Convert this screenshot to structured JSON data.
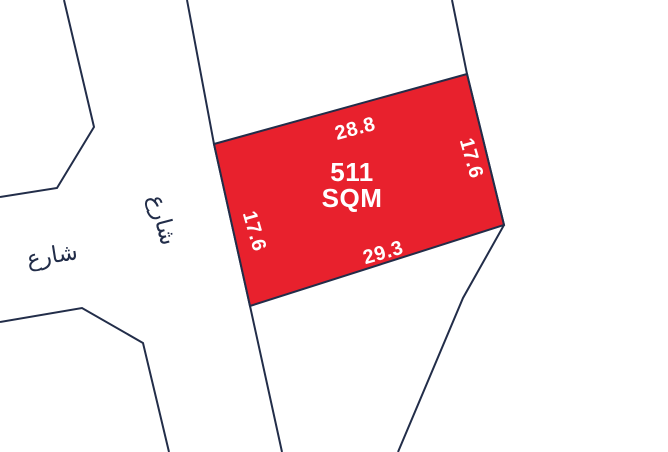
{
  "map": {
    "parcel": {
      "area_value": "511",
      "area_unit": "SQM",
      "dimensions": {
        "top": "28.8",
        "right": "17.6",
        "bottom": "29.3",
        "left": "17.6"
      }
    },
    "streets": {
      "left_street_label": "شارع",
      "middle_street_label": "شارع"
    }
  },
  "colors": {
    "parcel_fill": "#E8212D",
    "line_navy": "#222D49",
    "label_white": "#FFFFFF",
    "background": "#FFFFFF"
  }
}
